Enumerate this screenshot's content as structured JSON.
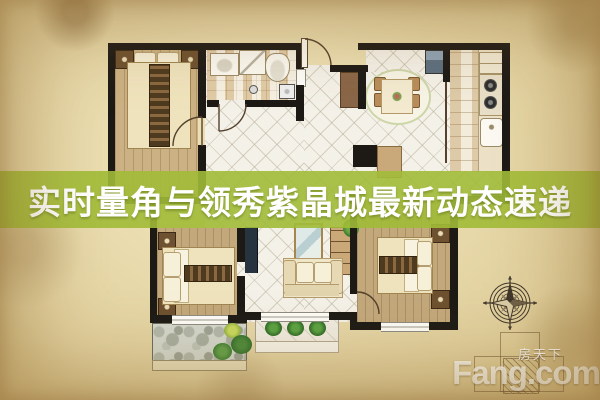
{
  "banner": {
    "title": "实时量角与领秀紫晶城最新动态速递",
    "background_color": "#a1bb37",
    "text_color": "#ffffff"
  },
  "watermark": {
    "logo_text": "Fang.com",
    "brand_cn": "房天下"
  },
  "icons": {
    "compass": "compass-rose-icon",
    "building_outline": "building-outline-icon",
    "entry_door": "door-arc-icon"
  },
  "colors": {
    "parchment": "#e0cf9c",
    "wall": "#1d1a16",
    "wood_floor": "#cbb183",
    "tile_floor": "#f4f1e8",
    "bath_tile": "#ecdfc2",
    "kitchen_counter": "#ece1c6",
    "balcony_stone": "#d3d7cc",
    "plant_green": "#3f8f35",
    "compass_ink": "#40362b",
    "watermark_white": "rgba(252,250,243,0.85)"
  }
}
